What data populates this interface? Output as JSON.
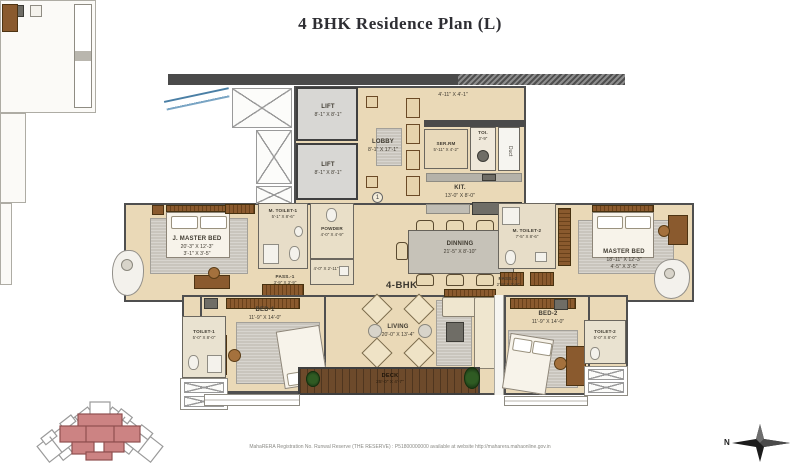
{
  "title": "4 BHK Residence Plan (L)",
  "unit_label": "4-BHK",
  "marker": "1",
  "north_label": "N",
  "footer": "MahaRERA Registration No. Runwal Reserve (THE RESERVE) : P51800000000 available at website http://maharera.mahaonline.gov.in",
  "rooms": {
    "lift1": {
      "name": "LIFT",
      "dims": "8'-1\" X 8'-1\""
    },
    "lift2": {
      "name": "LIFT",
      "dims": "8'-1\" X 8'-1\""
    },
    "lobby": {
      "name": "LOBBY",
      "dims": "8'-1\" X 17'-1\""
    },
    "foyer": {
      "dims": "4'-11\" X 4'-1\""
    },
    "ser_rm": {
      "name": "SER.RM",
      "dims": "5'-11\" X 4'-2\""
    },
    "toi": {
      "name": "TOI.",
      "dims": "2'-9\""
    },
    "duct": {
      "name": "Duct"
    },
    "kitchen": {
      "name": "KIT.",
      "dims": "13'-0\" X 8'-0\""
    },
    "j_master_bed": {
      "name": "J. MASTER BED",
      "dims": "20'-3\" X 12'-3\"",
      "dims2": "3'-1\" X 3'-5\""
    },
    "m_toilet_1": {
      "name": "M. TOILET-1",
      "dims": "5'-1\" X 8'-6\""
    },
    "powder": {
      "name": "POWDER",
      "dims": "4'-0\" X 4'-9\""
    },
    "store": {
      "dims": "4'-0\" X 2'-11\""
    },
    "pass_1": {
      "name": "PASS.-1",
      "dims": "3'-9\" X 3'-9\""
    },
    "dinning": {
      "name": "DINNING",
      "dims": "21'-5\" X 8'-10\""
    },
    "m_toilet_2": {
      "name": "M. TOILET-2",
      "dims": "7'-5\" X 8'-6\""
    },
    "pass_2": {
      "name": "PASS.-2",
      "dims": "2'-9\" X 3'-9\""
    },
    "master_bed": {
      "name": "MASTER BED",
      "dims": "18'-11\" X 12'-3\"",
      "dims2": "4'-5\" X 3'-5\""
    },
    "bed_1": {
      "name": "BED-1",
      "dims": "11'-9\" X 14'-0\""
    },
    "toilet_1": {
      "name": "TOILET-1",
      "dims": "5'-0\" X 8'-0\""
    },
    "living": {
      "name": "LIVING",
      "dims": "20'-0\" X 13'-4\""
    },
    "bed_2": {
      "name": "BED-2",
      "dims": "11'-9\" X 14'-0\""
    },
    "toilet_2": {
      "name": "TOILET-2",
      "dims": "5'-0\" X 8'-0\""
    },
    "deck": {
      "name": "DECK",
      "dims": "25'-0\" X 4'-7\""
    }
  },
  "colors": {
    "room_fill": "#ead9b7",
    "wall": "#4a4a4a",
    "lift_fill": "#d8d7d4",
    "deck_wood": "#6d4a2b",
    "keyplan_highlight": "#cc8383",
    "glass_accent": "#4a7fa5"
  }
}
